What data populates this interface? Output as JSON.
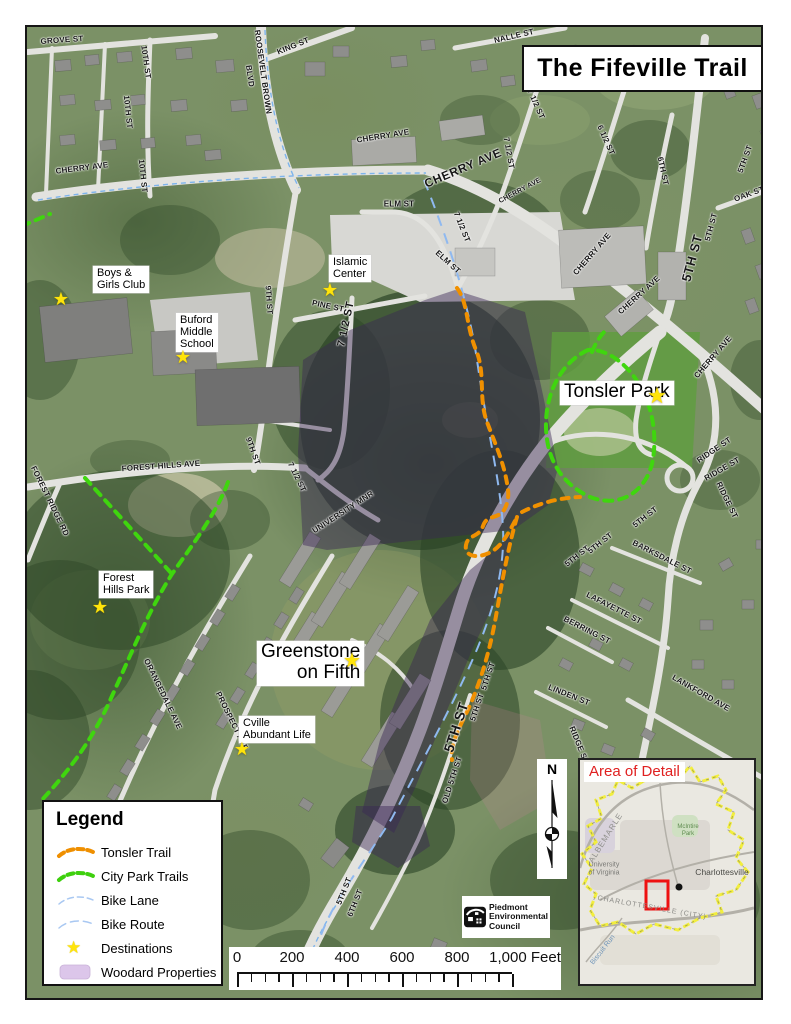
{
  "title": "The Fifeville Trail",
  "legend": {
    "title": "Legend",
    "items": [
      {
        "id": "tonsler-trail",
        "label": "Tonsler Trail",
        "symbol": "dash",
        "color": "#ef8f00"
      },
      {
        "id": "city-park-trails",
        "label": "City Park Trails",
        "symbol": "dash",
        "color": "#3ed00e"
      },
      {
        "id": "bike-lane",
        "label": "Bike Lane",
        "symbol": "thin-dash",
        "color": "#a9c8f2"
      },
      {
        "id": "bike-route",
        "label": "Bike Route",
        "symbol": "thin-dash2",
        "color": "#a9c8f2"
      },
      {
        "id": "destinations",
        "label": "Destinations",
        "symbol": "star",
        "color": "#ffe40a"
      },
      {
        "id": "woodard-properties",
        "label": "Woodard Properties",
        "symbol": "swatch",
        "color": "#dcc6ea"
      }
    ]
  },
  "scale_bar": {
    "labels": [
      "0",
      "200",
      "400",
      "600",
      "800",
      "1,000 Feet"
    ]
  },
  "north_arrow": {
    "label": "N"
  },
  "credit": {
    "lines": [
      "Piedmont",
      "Environmental",
      "Council"
    ]
  },
  "inset": {
    "title": "Area of Detail",
    "labels": [
      {
        "text": "ALBEMARLE",
        "x": 606,
        "y": 838,
        "rot": -58,
        "size": 8,
        "color": "#90908c",
        "ls": 1
      },
      {
        "text": "University",
        "x": 604,
        "y": 865,
        "rot": 0,
        "size": 7,
        "color": "#7a7a76",
        "ls": 0
      },
      {
        "text": "of Virginia",
        "x": 604,
        "y": 873,
        "rot": 0,
        "size": 7,
        "color": "#7a7a76",
        "ls": 0
      },
      {
        "text": "Charlottesville",
        "x": 722,
        "y": 872,
        "rot": 0,
        "size": 8.5,
        "color": "#4a4a46",
        "ls": 0
      },
      {
        "text": "CHARLOTTESVILLE (CITY)",
        "x": 652,
        "y": 908,
        "rot": 10,
        "size": 7,
        "color": "#8a8a86",
        "ls": 1
      },
      {
        "text": "McIntire",
        "x": 688,
        "y": 827,
        "rot": 0,
        "size": 6,
        "color": "#5d8a4e",
        "ls": 0
      },
      {
        "text": "Park",
        "x": 688,
        "y": 834,
        "rot": 0,
        "size": 6,
        "color": "#5d8a4e",
        "ls": 0
      },
      {
        "text": "Biscuit Run",
        "x": 603,
        "y": 950,
        "rot": -52,
        "size": 7,
        "color": "#6f94b8",
        "ls": 0
      }
    ]
  },
  "destinations": [
    {
      "id": "boys-girls-club",
      "lines": [
        "Boys &",
        "Girls Club"
      ],
      "lx": 93,
      "ly": 266,
      "sx": 61,
      "sy": 299,
      "size": 11,
      "align": "left",
      "star": 18
    },
    {
      "id": "buford-middle-school",
      "lines": [
        "Buford",
        "Middle",
        "School"
      ],
      "lx": 176,
      "ly": 313,
      "sx": 183,
      "sy": 357,
      "size": 11,
      "align": "left",
      "star": 18
    },
    {
      "id": "islamic-center",
      "lines": [
        "Islamic",
        "Center"
      ],
      "lx": 329,
      "ly": 255,
      "sx": 330,
      "sy": 290,
      "size": 11,
      "align": "left",
      "star": 18
    },
    {
      "id": "tonsler-park",
      "lines": [
        "Tonsler Park"
      ],
      "lx": 560,
      "ly": 381,
      "sx": 657,
      "sy": 396,
      "size": 19,
      "align": "left",
      "star": 22
    },
    {
      "id": "forest-hills-park",
      "lines": [
        "Forest",
        "Hills Park"
      ],
      "lx": 99,
      "ly": 571,
      "sx": 100,
      "sy": 607,
      "size": 11,
      "align": "left",
      "star": 18
    },
    {
      "id": "greenstone-on-fifth",
      "lines": [
        "Greenstone",
        "on Fifth"
      ],
      "lx": 257,
      "ly": 641,
      "sx": 352,
      "sy": 661,
      "size": 19,
      "align": "right",
      "star": 20
    },
    {
      "id": "cville-abundant-life",
      "lines": [
        "Cville",
        "Abundant Life"
      ],
      "lx": 239,
      "ly": 716,
      "sx": 242,
      "sy": 749,
      "size": 11,
      "align": "left",
      "star": 18
    }
  ],
  "street_labels": [
    {
      "t": "GROVE ST",
      "x": 62,
      "y": 40,
      "r": -4,
      "s": 8
    },
    {
      "t": "10TH ST",
      "x": 146,
      "y": 62,
      "r": 82,
      "s": 8
    },
    {
      "t": "10TH ST",
      "x": 128,
      "y": 112,
      "r": 84,
      "s": 8
    },
    {
      "t": "10TH ST",
      "x": 143,
      "y": 176,
      "r": 84,
      "s": 8
    },
    {
      "t": "ROOSEVELT BROWN",
      "x": 263,
      "y": 72,
      "r": 82,
      "s": 8
    },
    {
      "t": "BLVD",
      "x": 250,
      "y": 76,
      "r": 82,
      "s": 8
    },
    {
      "t": "KING ST",
      "x": 293,
      "y": 46,
      "r": -22,
      "s": 8
    },
    {
      "t": "CHERRY AVE",
      "x": 82,
      "y": 168,
      "r": -7,
      "s": 8
    },
    {
      "t": "CHERRY AVE",
      "x": 383,
      "y": 136,
      "r": -9,
      "s": 8
    },
    {
      "t": "CHERRY AVE",
      "x": 463,
      "y": 168,
      "r": -23,
      "s": 12,
      "b": 1
    },
    {
      "t": "CHERRY AVE",
      "x": 520,
      "y": 191,
      "r": -28,
      "s": 7
    },
    {
      "t": "NALLE ST",
      "x": 514,
      "y": 36,
      "r": -13,
      "s": 8
    },
    {
      "t": "7 1/2 ST",
      "x": 536,
      "y": 104,
      "r": 66,
      "s": 8
    },
    {
      "t": "7 1/2 ST",
      "x": 509,
      "y": 153,
      "r": 80,
      "s": 8
    },
    {
      "t": "6 1/2 ST",
      "x": 606,
      "y": 140,
      "r": 66,
      "s": 8
    },
    {
      "t": "6TH ST",
      "x": 663,
      "y": 171,
      "r": 78,
      "s": 8
    },
    {
      "t": "5TH ST",
      "x": 692,
      "y": 258,
      "r": -75,
      "s": 13,
      "b": 1
    },
    {
      "t": "5TH ST",
      "x": 711,
      "y": 227,
      "r": -75,
      "s": 8
    },
    {
      "t": "5TH ST",
      "x": 745,
      "y": 159,
      "r": -70,
      "s": 8
    },
    {
      "t": "OAK ST",
      "x": 749,
      "y": 194,
      "r": -20,
      "s": 8
    },
    {
      "t": "CHERRY AVE",
      "x": 592,
      "y": 254,
      "r": -49,
      "s": 8
    },
    {
      "t": "CHERRY AVE",
      "x": 639,
      "y": 295,
      "r": -42,
      "s": 8
    },
    {
      "t": "CHERRY AVE",
      "x": 713,
      "y": 357,
      "r": -49,
      "s": 8
    },
    {
      "t": "ELM ST",
      "x": 399,
      "y": 204,
      "r": 0,
      "s": 8
    },
    {
      "t": "ELM ST",
      "x": 448,
      "y": 262,
      "r": 42,
      "s": 8
    },
    {
      "t": "7 1/2 ST",
      "x": 462,
      "y": 227,
      "r": 68,
      "s": 8
    },
    {
      "t": "PINE ST",
      "x": 328,
      "y": 306,
      "r": 12,
      "s": 8
    },
    {
      "t": "9TH ST",
      "x": 269,
      "y": 300,
      "r": 86,
      "s": 8
    },
    {
      "t": "9TH ST",
      "x": 253,
      "y": 451,
      "r": 70,
      "s": 8
    },
    {
      "t": "7 1/2 ST",
      "x": 346,
      "y": 324,
      "r": -78,
      "s": 11,
      "b": 1
    },
    {
      "t": "7 1/2 ST",
      "x": 297,
      "y": 477,
      "r": 64,
      "s": 8
    },
    {
      "t": "FOREST HILLS AVE",
      "x": 161,
      "y": 466,
      "r": -4,
      "s": 8
    },
    {
      "t": "FOREST RIDGE RD",
      "x": 50,
      "y": 501,
      "r": 64,
      "s": 8
    },
    {
      "t": "UNIVERSITY MNR",
      "x": 343,
      "y": 512,
      "r": -33,
      "s": 8
    },
    {
      "t": "ORANGEDALE AVE",
      "x": 163,
      "y": 694,
      "r": 64,
      "s": 8
    },
    {
      "t": "PROSPECT AVE",
      "x": 232,
      "y": 721,
      "r": 64,
      "s": 8
    },
    {
      "t": "5TH ST",
      "x": 456,
      "y": 727,
      "r": -72,
      "s": 14,
      "b": 1
    },
    {
      "t": "5TH ST",
      "x": 488,
      "y": 676,
      "r": -72,
      "s": 8
    },
    {
      "t": "5TH ST",
      "x": 477,
      "y": 707,
      "r": -72,
      "s": 8
    },
    {
      "t": "OLD 5TH ST",
      "x": 452,
      "y": 780,
      "r": -72,
      "s": 8
    },
    {
      "t": "5TH ST",
      "x": 577,
      "y": 556,
      "r": -38,
      "s": 8
    },
    {
      "t": "5TH ST",
      "x": 600,
      "y": 543,
      "r": -38,
      "s": 8
    },
    {
      "t": "5TH ST",
      "x": 645,
      "y": 517,
      "r": -38,
      "s": 8
    },
    {
      "t": "RIDGE ST",
      "x": 714,
      "y": 450,
      "r": -34,
      "s": 8
    },
    {
      "t": "RIDGE ST",
      "x": 722,
      "y": 469,
      "r": -30,
      "s": 8
    },
    {
      "t": "RIDGE ST",
      "x": 727,
      "y": 500,
      "r": 64,
      "s": 8
    },
    {
      "t": "RIDGE ST",
      "x": 579,
      "y": 745,
      "r": 68,
      "s": 8
    },
    {
      "t": "BARKSDALE ST",
      "x": 662,
      "y": 557,
      "r": 27,
      "s": 8
    },
    {
      "t": "LAFAYETTE ST",
      "x": 614,
      "y": 608,
      "r": 27,
      "s": 8
    },
    {
      "t": "BERRING ST",
      "x": 587,
      "y": 630,
      "r": 27,
      "s": 8
    },
    {
      "t": "LINDEN ST",
      "x": 569,
      "y": 695,
      "r": 22,
      "s": 8
    },
    {
      "t": "LANKFORD AVE",
      "x": 701,
      "y": 693,
      "r": 30,
      "s": 8
    },
    {
      "t": "5TH ST",
      "x": 344,
      "y": 891,
      "r": -68,
      "s": 8
    },
    {
      "t": "6TH ST",
      "x": 355,
      "y": 903,
      "r": -68,
      "s": 8
    }
  ]
}
